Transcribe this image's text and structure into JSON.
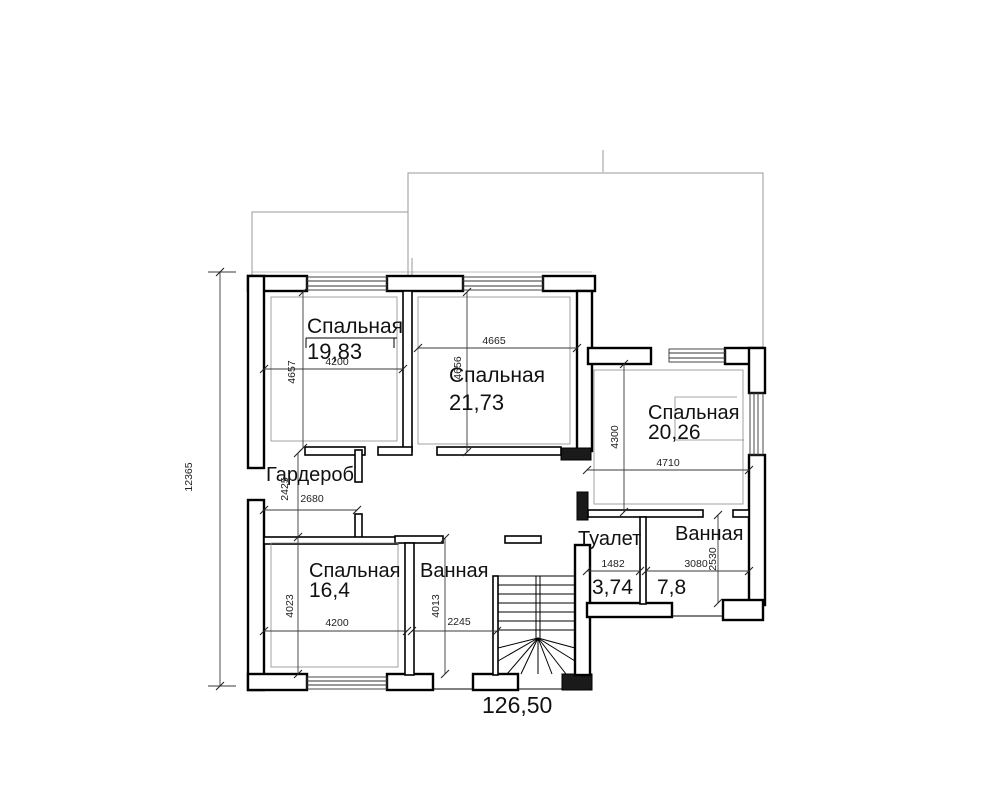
{
  "plan": {
    "total_area": "126,50",
    "overall": {
      "height_mm": "12365"
    },
    "rooms": {
      "bedroom1": {
        "name": "Спальная",
        "area": "19,83",
        "width_mm": "4200",
        "height_mm": "4657"
      },
      "bedroom2": {
        "name": "Спальная",
        "area": "21,73",
        "width_mm": "4665",
        "height_mm": "4656"
      },
      "bedroom3": {
        "name": "Спальная",
        "area": "20,26",
        "width_mm": "4710",
        "height_mm": "4300"
      },
      "wardrobe": {
        "name": "Гардероб",
        "width_mm": "2680",
        "height_mm": "2425"
      },
      "bedroom4": {
        "name": "Спальная",
        "area": "16,4",
        "width_mm": "4200",
        "height_mm": "4023"
      },
      "bathroom_left": {
        "name": "Ванная",
        "width_mm": "2245",
        "height_mm": "4013"
      },
      "toilet": {
        "name": "Туалет",
        "area": "3,74",
        "width_mm": "1482"
      },
      "bathroom_right": {
        "name": "Ванная",
        "area": "7,8",
        "width_mm": "3080",
        "height_mm": "2530"
      }
    }
  }
}
